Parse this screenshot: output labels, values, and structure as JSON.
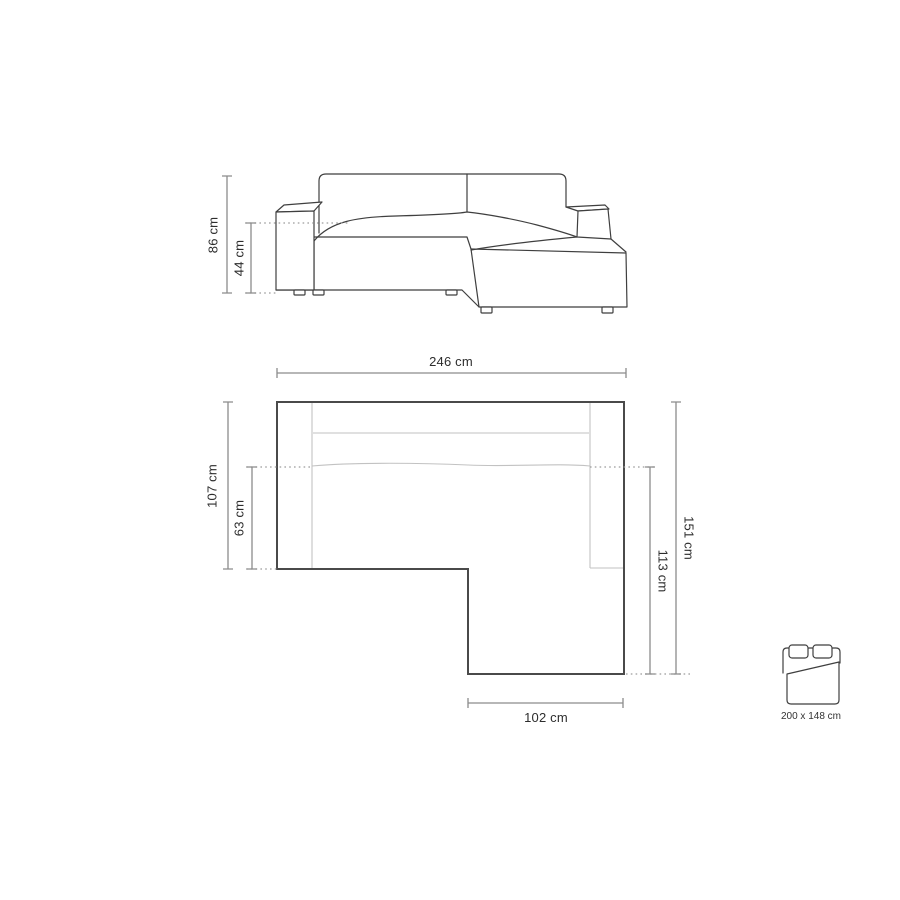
{
  "diagram": {
    "name": "Corner sofa dimensions diagram",
    "front_view": {
      "name": "front elevation",
      "dims": {
        "total_height": {
          "label": "86 cm",
          "value_cm": 86
        },
        "seat_height": {
          "label": "44 cm",
          "value_cm": 44
        }
      }
    },
    "top_view": {
      "name": "top plan",
      "dims": {
        "total_width": {
          "label": "246 cm",
          "value_cm": 246
        },
        "left_depth": {
          "label": "107 cm",
          "value_cm": 107
        },
        "seat_depth": {
          "label": "63 cm",
          "value_cm": 63
        },
        "right_depth": {
          "label": "151 cm",
          "value_cm": 151
        },
        "chaise_depth": {
          "label": "113 cm",
          "value_cm": 113
        },
        "chaise_width": {
          "label": "102 cm",
          "value_cm": 102
        }
      }
    },
    "sleeping_area": {
      "label": "200 x 148 cm",
      "width_cm": 200,
      "depth_cm": 148
    },
    "colors": {
      "background": "#ffffff",
      "drawing_outline": "#3f3f3f",
      "plan_outline": "#4a4a4a",
      "inner_line": "#c2c2c2",
      "dimension_line": "#8c8c8c",
      "dotted_line": "#9c9c9c",
      "text": "#2d2d2d"
    }
  }
}
